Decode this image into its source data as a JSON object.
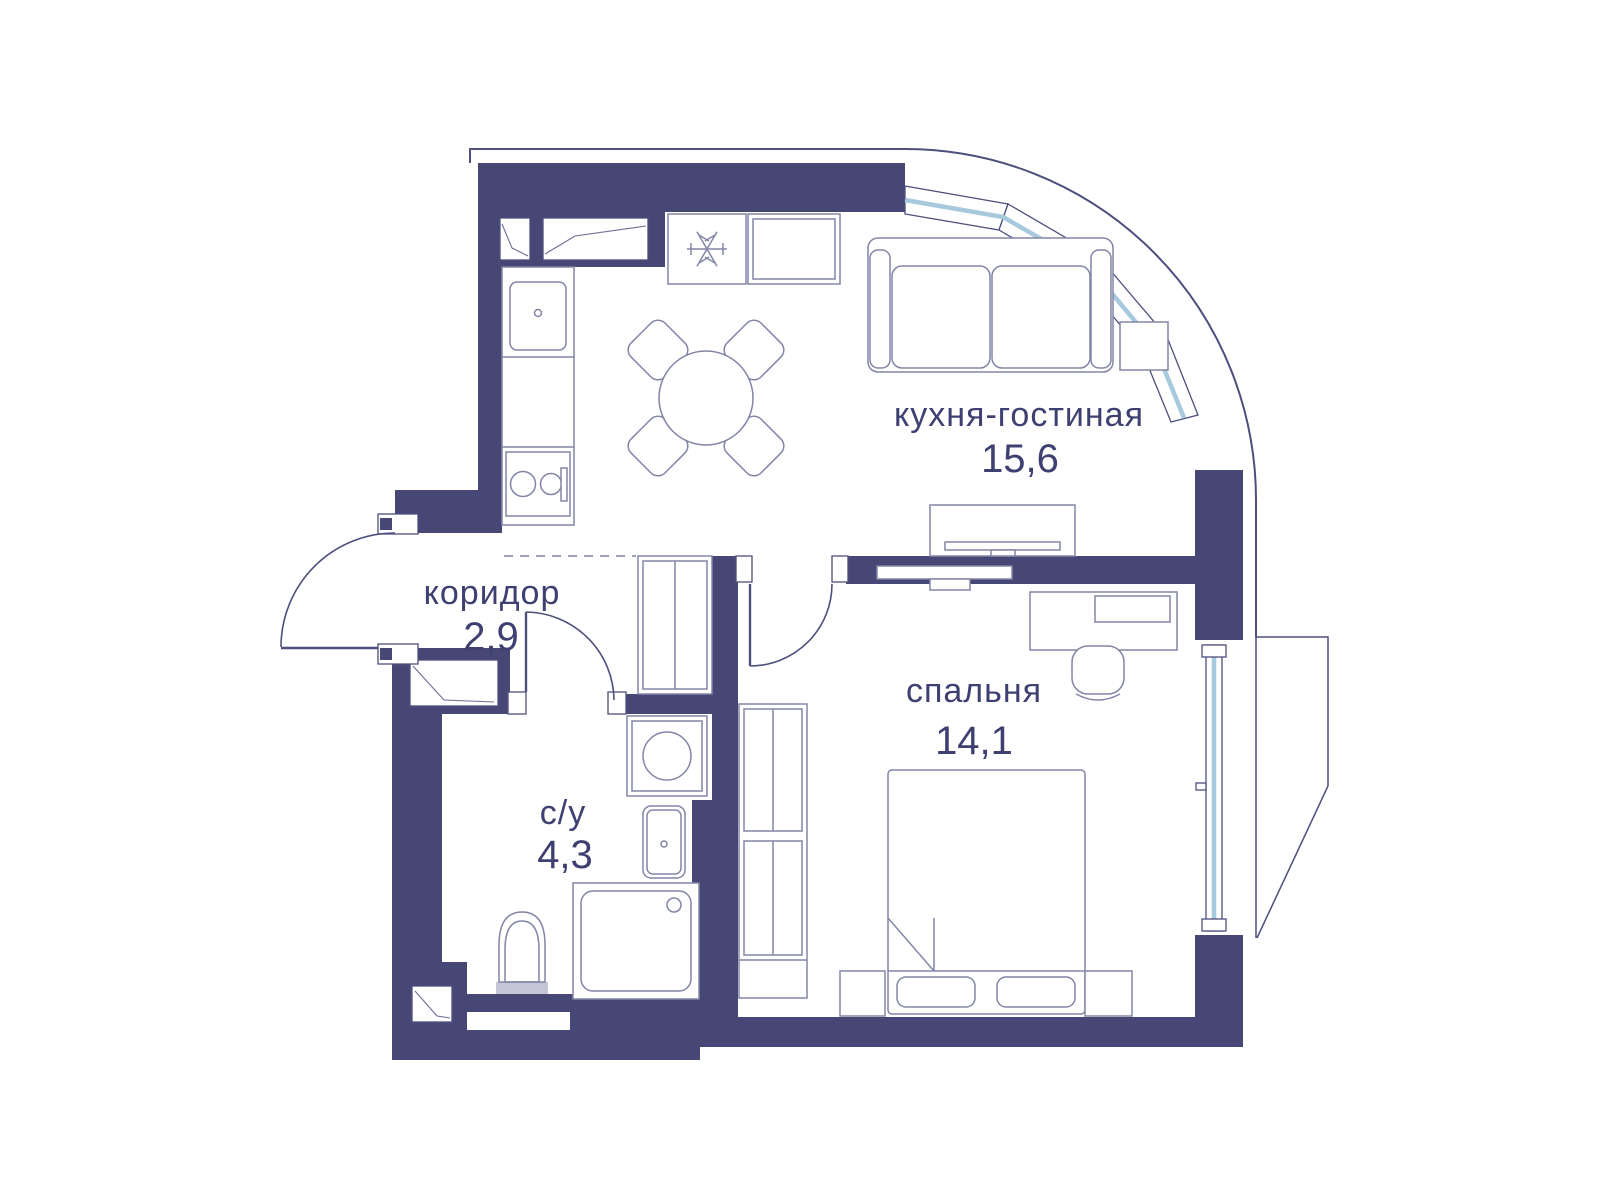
{
  "plan_title": "apartment-floor-plan",
  "rooms": [
    {
      "name": "кухня-гостиная",
      "area": "15,6"
    },
    {
      "name": "спальня",
      "area": "14,1"
    },
    {
      "name": "коридор",
      "area": "2,9"
    },
    {
      "name": "с/у",
      "area": "4,3"
    }
  ],
  "colors": {
    "wall": "#464775",
    "outline": "#4d4f7c",
    "furniture_line": "#8285a5",
    "window_glass": "#a6c9de",
    "label_text": "#3d4070",
    "background": "#ffffff"
  },
  "furniture_icons": [
    "sofa",
    "side-table",
    "tv-stand",
    "tv",
    "dining-table",
    "dining-chairs",
    "kitchen-counter",
    "kitchen-sink",
    "stove",
    "fridge-snowflake",
    "corridor-wardrobe",
    "bedroom-wardrobe",
    "double-bed",
    "nightstand",
    "desk",
    "desk-chair",
    "washing-machine",
    "bathroom-sink",
    "shower",
    "toilet"
  ]
}
